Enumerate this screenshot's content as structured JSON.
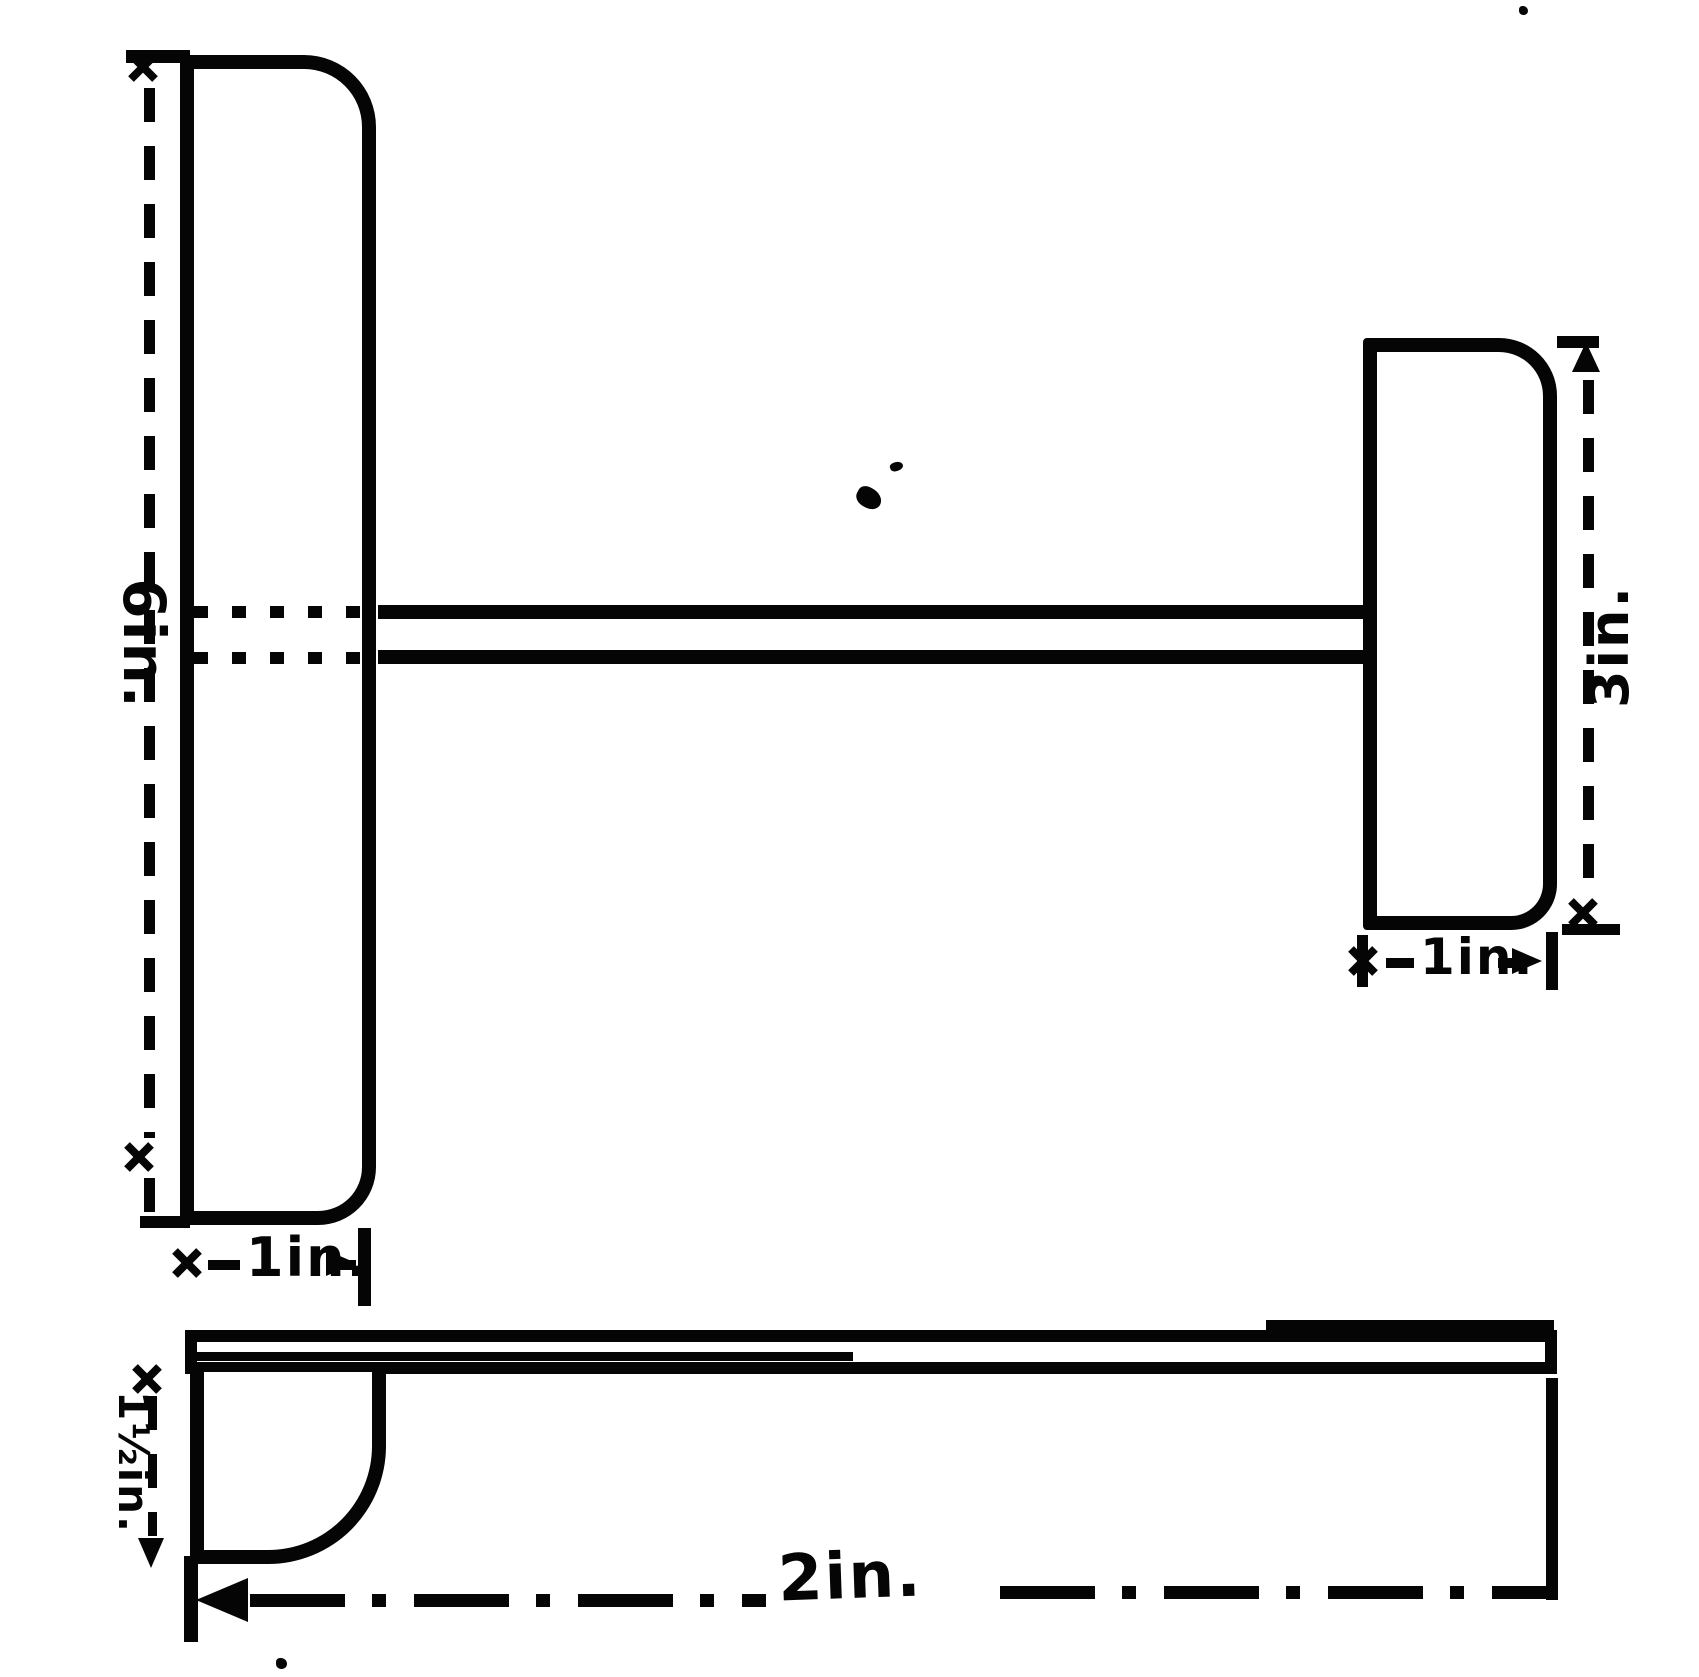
{
  "plan_view": {
    "left_blade": {
      "height": "6in.",
      "width": "1in."
    },
    "right_blade": {
      "height": "3in.",
      "width": "1in."
    }
  },
  "side_view": {
    "thickness": "1½in.",
    "length": "2in."
  },
  "colors": {
    "ink": "#050505",
    "paper": "#ffffff"
  }
}
